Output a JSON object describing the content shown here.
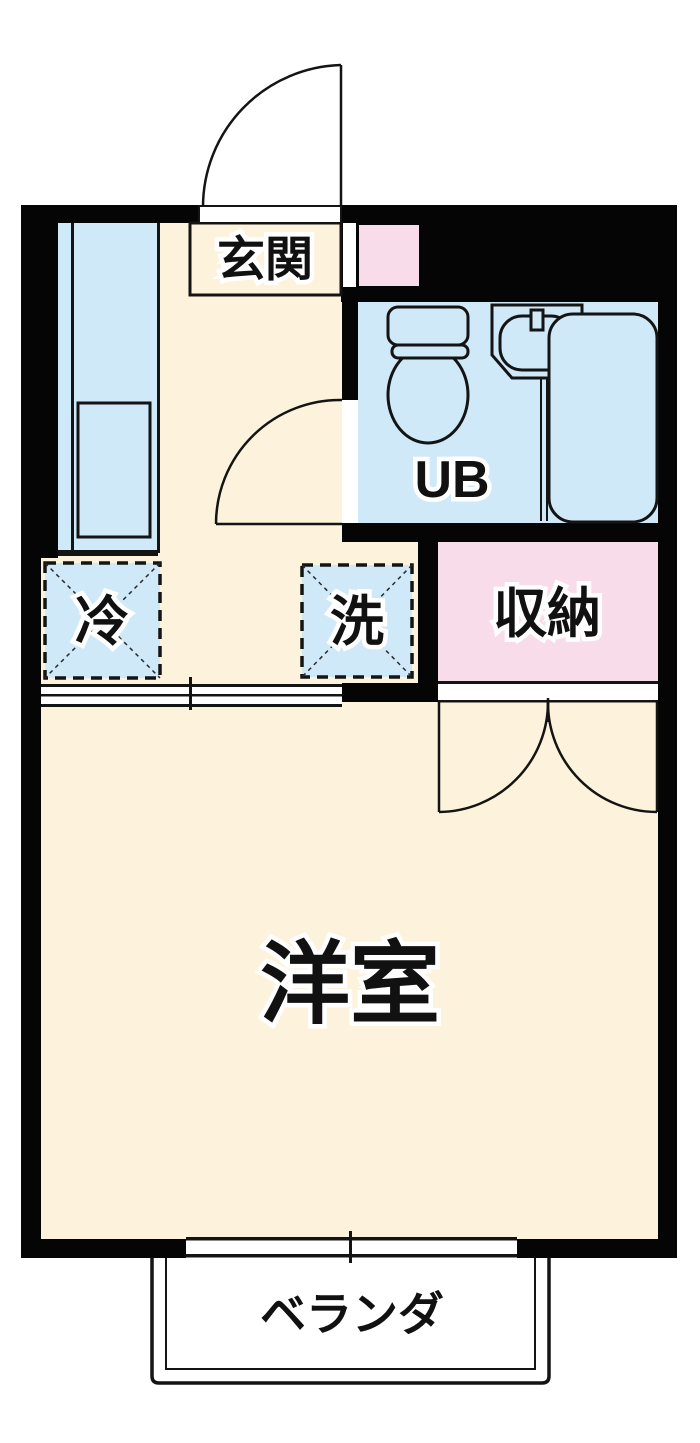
{
  "plan": {
    "type": "apartment-floor-plan",
    "rooms": {
      "genkan": "玄関",
      "unit_bath": "UB",
      "storage": "収納",
      "refrigerator": "冷",
      "washer": "洗",
      "western_room": "洋室",
      "veranda": "ベランダ"
    },
    "colors": {
      "floor_cream": "#fdf3dc",
      "water_blue": "#cfe9f8",
      "closet_pink": "#f8dce9",
      "wall_black": "#050505",
      "background": "#ffffff"
    }
  }
}
